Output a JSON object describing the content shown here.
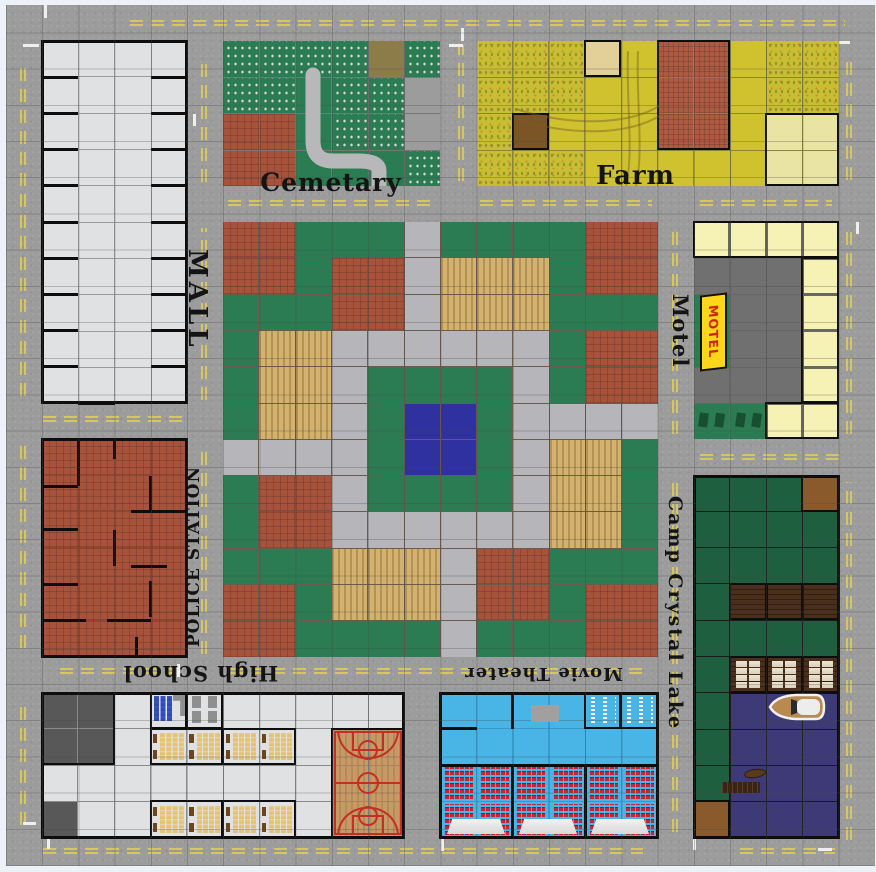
{
  "labels": {
    "mall": "MALL",
    "cemetery": "Cemetary",
    "farm": "Farm",
    "motel": "Motel",
    "motel_sign": "MOTEL",
    "police": "POLICE STATION",
    "school": "High School",
    "theater": "Movie Theater",
    "camp": "Camp Crystal Lake"
  },
  "colors": {
    "road": "#9c9c9c",
    "marking_yellow": "#d8c95a",
    "marking_white": "#efefef",
    "park_grass": "#2c7c53",
    "forest": "#1e5f40",
    "lake": "#3e3a78",
    "pool": "#2f31a0",
    "brick": "#a7523a",
    "path": "#b6b6ba",
    "field_yellow": "#cfc22e",
    "motel_yellow": "#f6f1b4",
    "parking": "#707070",
    "theater_blue": "#49b4e6",
    "seat_red": "#c22638",
    "court_wood": "#c69a66",
    "floor": "#dfe1e3",
    "sign_yellow": "#ffd61c",
    "sign_text": "#d42211"
  },
  "board": {
    "left": 5.8,
    "top": 4.8,
    "tile": 36.2,
    "grid_cols": 24,
    "grid_rows": 24,
    "legend": {
      "G": "grass",
      "e": "grass",
      "R": "brick-plaza",
      "T": "garden-plot",
      "P": "path",
      "B": "pool",
      "g": "graves",
      "o": "dirt-plot",
      "y": "pavement",
      "r": "brick-floor",
      "f": "cornfield",
      "Y": "field",
      "c": "hay-square",
      "b": "dirt-patch",
      "H": "barn-roof",
      "p": "hay-field",
      "M": "motel-room",
      "D": "parking-lot",
      "S": "sign-lawn",
      "V": "parked-cars-lawn",
      "F": "forest",
      "W": "cabin-floor",
      "C": "cabin",
      "K": "bunk-cabin",
      "L": "lake-water",
      "A": "camp-ground",
      "w": "floor",
      "d": "dark-room",
      "l": "locker-room",
      "u": "restroom",
      "k": "classroom",
      "q": "basketball-court",
      "z": "lobby-floor",
      "s": "theater-seats",
      "n": "concession-stand"
    },
    "blocks": [
      {
        "id": "mall",
        "col": 1,
        "row": 1,
        "cols": 4,
        "rows": 10,
        "lines": "#9a9a9a",
        "outline": true,
        "grid": [
          "wwww",
          "wwww",
          "wwww",
          "wwww",
          "wwww",
          "wwww",
          "wwww",
          "wwww",
          "wwww",
          "wwww"
        ],
        "walls": [
          [
            "h",
            0,
            1,
            1
          ],
          [
            "h",
            3,
            1,
            1
          ],
          [
            "h",
            0,
            2,
            1
          ],
          [
            "h",
            3,
            2,
            1
          ],
          [
            "h",
            0,
            3,
            1
          ],
          [
            "h",
            3,
            3,
            1
          ],
          [
            "h",
            0,
            4,
            1
          ],
          [
            "h",
            3,
            4,
            1
          ],
          [
            "h",
            0,
            5,
            1
          ],
          [
            "h",
            3,
            5,
            1
          ],
          [
            "h",
            0,
            6,
            1
          ],
          [
            "h",
            3,
            6,
            1
          ],
          [
            "h",
            0,
            7,
            1
          ],
          [
            "h",
            3,
            7,
            1
          ],
          [
            "h",
            0,
            8,
            1
          ],
          [
            "h",
            3,
            8,
            1
          ],
          [
            "h",
            0,
            9,
            1
          ],
          [
            "h",
            3,
            9,
            1
          ],
          [
            "h",
            1,
            10,
            1
          ]
        ]
      },
      {
        "id": "cemetery",
        "col": 6,
        "row": 1,
        "cols": 6,
        "rows": 4,
        "lines": "#777777",
        "grid": [
          "ggggog",
          "ggeggy",
          "rreggy",
          "rreeeg"
        ],
        "walls": []
      },
      {
        "id": "farm",
        "col": 13,
        "row": 1,
        "cols": 10,
        "rows": 4,
        "lines": "#8a8638",
        "grid": [
          "fffcYHHYff",
          "fffYYHHYff",
          "fbYYYHHYpp",
          "fffYYYYYpp"
        ],
        "walls": [
          [
            "box",
            5,
            0,
            2,
            3
          ],
          [
            "box",
            3,
            0,
            1,
            1
          ],
          [
            "box",
            1,
            2,
            1,
            1
          ],
          [
            "box",
            8,
            2,
            2,
            2
          ]
        ]
      },
      {
        "id": "motel",
        "col": 19,
        "row": 6,
        "cols": 4,
        "rows": 6,
        "lines": "#666666",
        "grid": [
          "MMMM",
          "DDDM",
          "SDDM",
          "SDDM",
          "DDDM",
          "VVMM"
        ],
        "walls": [
          [
            "box",
            0,
            0,
            4,
            1
          ],
          [
            "box",
            3,
            1,
            1,
            4
          ],
          [
            "box",
            2,
            5,
            2,
            1
          ]
        ]
      },
      {
        "id": "park",
        "col": 6,
        "row": 6,
        "cols": 12,
        "rows": 12,
        "lines": "#6b5a4e",
        "grid": [
          "RRGGGPGGGGRR",
          "RRGRRPTTTGRR",
          "GGGRRPTTTGGG",
          "GTTPPPPPPGRR",
          "GTTPGGGGPGRR",
          "GTTPGBBGPPPP",
          "PPPPGBBGPTTG",
          "GRRPGGGGPTTG",
          "GRRPPPPPPTTG",
          "GGGTTTPRRGGG",
          "RRGTTTPRRGRR",
          "RRGGGGPGGGRR"
        ],
        "walls": []
      },
      {
        "id": "police-station",
        "col": 1,
        "row": 12,
        "cols": 4,
        "rows": 6,
        "lines": "#8f4631",
        "outline": true,
        "grid": [
          "rrrr",
          "rrrr",
          "rrrr",
          "rrrr",
          "rrrr",
          "rrrr"
        ],
        "walls": [
          [
            "v",
            1,
            0,
            1.3
          ],
          [
            "v",
            2,
            0,
            0.55
          ],
          [
            "h",
            0,
            1.3,
            1
          ],
          [
            "v",
            3,
            1,
            1
          ],
          [
            "h",
            2.45,
            2,
            1.55
          ],
          [
            "h",
            0,
            2.5,
            1
          ],
          [
            "v",
            2,
            2.5,
            1
          ],
          [
            "h",
            2.45,
            3.5,
            1
          ],
          [
            "h",
            0,
            4,
            1
          ],
          [
            "v",
            3,
            3.9,
            1
          ],
          [
            "h",
            0,
            5,
            1.2
          ],
          [
            "h",
            1.8,
            5,
            1.2
          ],
          [
            "v",
            2.6,
            5.45,
            0.55
          ]
        ]
      },
      {
        "id": "high-school",
        "col": 1,
        "row": 19,
        "cols": 10,
        "rows": 4,
        "lines": "#8a8a8a",
        "outline": true,
        "grid": [
          "ddwluwwwww",
          "ddwkkkkwqq",
          "wwwwwwwwqq",
          "dwwkkkkwqq"
        ],
        "walls": [
          [
            "box",
            0,
            0,
            2,
            2
          ],
          [
            "box",
            3,
            0,
            1,
            1
          ],
          [
            "box",
            4,
            0,
            1,
            1
          ],
          [
            "box",
            3,
            1,
            2,
            1
          ],
          [
            "box",
            5,
            1,
            2,
            1
          ],
          [
            "box",
            3,
            3,
            2,
            1
          ],
          [
            "box",
            5,
            3,
            2,
            1
          ],
          [
            "box",
            8,
            1,
            2,
            3
          ]
        ]
      },
      {
        "id": "movie-theater",
        "col": 12,
        "row": 19,
        "cols": 6,
        "rows": 4,
        "lines": "#3a99c9",
        "outline": true,
        "grid": [
          "zzzznn",
          "zzzzzz",
          "ssssss",
          "ssssss"
        ],
        "walls": [
          [
            "box",
            4,
            0,
            1,
            1
          ],
          [
            "box",
            5,
            0,
            1,
            1
          ],
          [
            "h",
            0,
            1,
            1
          ],
          [
            "v",
            2,
            0,
            1
          ],
          [
            "h",
            0,
            2,
            6
          ],
          [
            "v",
            2,
            2,
            2
          ],
          [
            "v",
            4,
            2,
            2
          ]
        ]
      },
      {
        "id": "camp-crystal-lake",
        "col": 19,
        "row": 13,
        "cols": 4,
        "rows": 10,
        "lines": "#1a1a1a",
        "outline": true,
        "grid": [
          "FFFW",
          "FFFF",
          "FFFF",
          "FCCC",
          "FFFF",
          "FKKK",
          "FLLL",
          "FLLL",
          "FLLL",
          "ALLL"
        ],
        "walls": [
          [
            "box",
            1,
            3,
            3,
            1
          ],
          [
            "v",
            2,
            3,
            1
          ],
          [
            "v",
            3,
            3,
            1
          ],
          [
            "box",
            1,
            5,
            3,
            1
          ],
          [
            "v",
            2,
            5,
            1
          ],
          [
            "v",
            3,
            5,
            1
          ],
          [
            "box",
            1,
            6,
            3,
            4
          ],
          [
            "box",
            3,
            0,
            1,
            1
          ],
          [
            "box",
            0,
            9,
            1,
            1
          ]
        ]
      }
    ]
  },
  "road_markings": {
    "yellow": [
      [
        "h",
        130,
        20,
        715
      ],
      [
        "h",
        228,
        200,
        208
      ],
      [
        "h",
        480,
        200,
        172
      ],
      [
        "h",
        700,
        200,
        132
      ],
      [
        "h",
        43,
        416,
        142
      ],
      [
        "h",
        60,
        668,
        116
      ],
      [
        "h",
        230,
        668,
        420
      ],
      [
        "h",
        700,
        454,
        140
      ],
      [
        "h",
        43,
        848,
        600
      ],
      [
        "h",
        740,
        848,
        95
      ],
      [
        "v",
        20,
        60,
        336
      ],
      [
        "v",
        20,
        446,
        202
      ],
      [
        "v",
        20,
        700,
        125
      ],
      [
        "v",
        201,
        60,
        122
      ],
      [
        "v",
        201,
        228,
        172
      ],
      [
        "v",
        201,
        444,
        210
      ],
      [
        "v",
        458,
        45,
        136
      ],
      [
        "v",
        672,
        228,
        206
      ],
      [
        "v",
        672,
        482,
        350
      ],
      [
        "v",
        846,
        60,
        120
      ],
      [
        "v",
        846,
        230,
        204
      ],
      [
        "v",
        846,
        482,
        358
      ]
    ],
    "white": [
      [
        23,
        44,
        16,
        3
      ],
      [
        44,
        5,
        3,
        13
      ],
      [
        449,
        44,
        14,
        3
      ],
      [
        461,
        28,
        3,
        13
      ],
      [
        836,
        41,
        14,
        3
      ],
      [
        193,
        114,
        3,
        12
      ],
      [
        47,
        836,
        3,
        13
      ],
      [
        441,
        838,
        3,
        13
      ],
      [
        693,
        838,
        3,
        12
      ],
      [
        818,
        848,
        14,
        3
      ],
      [
        23,
        822,
        13,
        3
      ],
      [
        177,
        664,
        3,
        13
      ],
      [
        856,
        222,
        3,
        12
      ]
    ]
  },
  "decorations": {
    "theater_screens": [
      [
        447,
        819
      ],
      [
        519,
        819
      ],
      [
        591,
        819
      ]
    ],
    "boat": {
      "x": 766,
      "y": 692,
      "w": 62,
      "h": 30
    },
    "dock": {
      "x": 722,
      "y": 782
    },
    "court": {
      "x": 332,
      "y": 729,
      "w": 72,
      "h": 108
    }
  }
}
